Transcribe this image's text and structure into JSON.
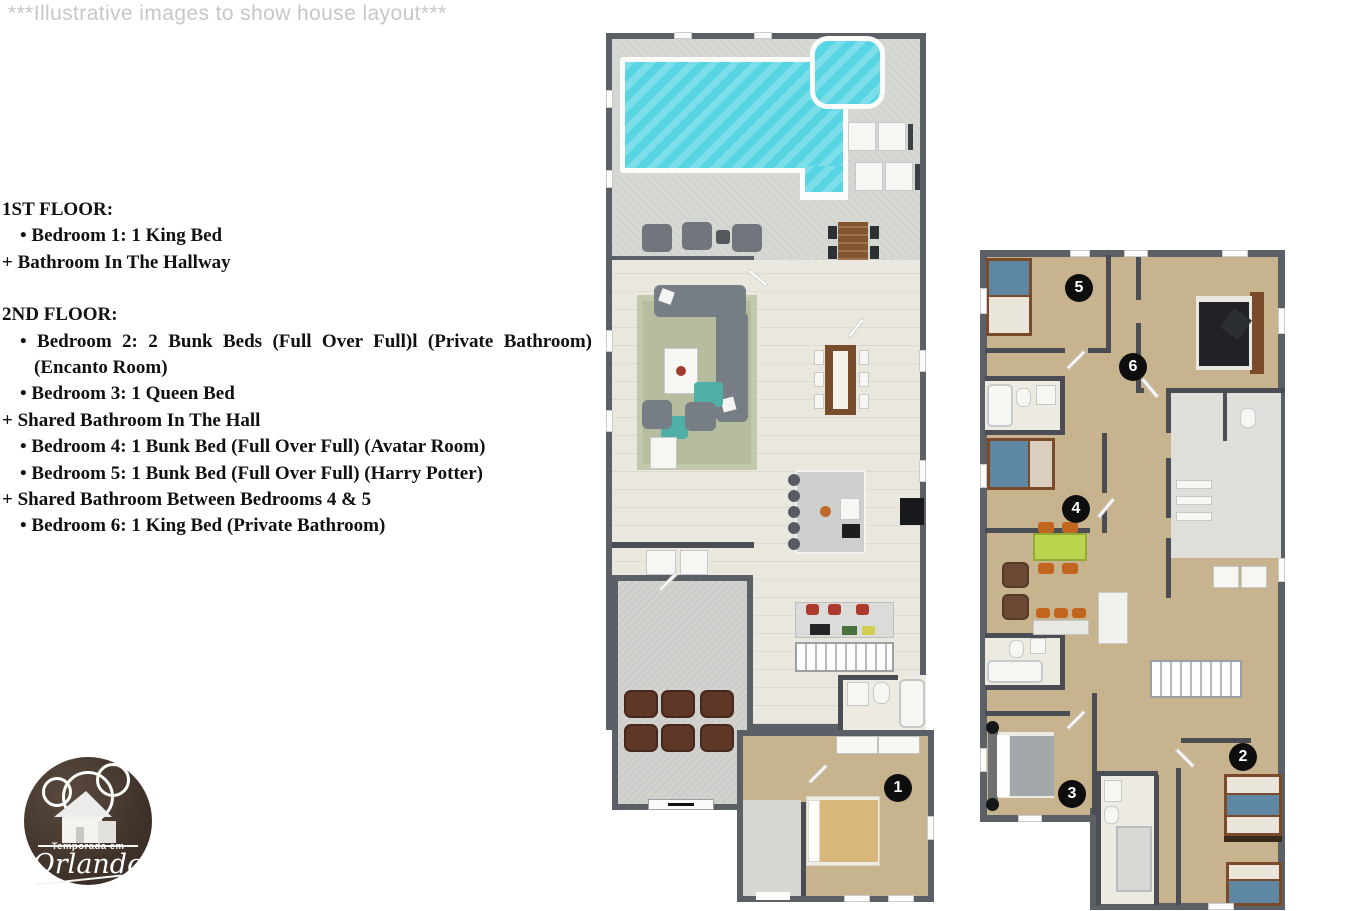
{
  "watermark": "***Illustrative images to show house layout***",
  "info": {
    "f1_heading": "1ST FLOOR:",
    "f1_line1": "• Bedroom 1: 1 King Bed",
    "f1_line2": "+ Bathroom In The Hallway",
    "f2_heading": "2ND FLOOR:",
    "f2_line1": "• Bedroom 2: 2 Bunk Beds (Full Over Full)l (Private Bathroom)",
    "f2_line1b": "(Encanto Room)",
    "f2_line2": "• Bedroom 3: 1 Queen Bed",
    "f2_line3": "+ Shared Bathroom In The Hall",
    "f2_line4": "• Bedroom 4: 1 Bunk Bed (Full Over Full) (Avatar Room)",
    "f2_line5": "• Bedroom 5: 1 Bunk Bed (Full Over Full) (Harry Potter)",
    "f2_line6": "+ Shared Bathroom Between Bedrooms 4 & 5",
    "f2_line7": "• Bedroom 6: 1 King Bed (Private Bathroom)"
  },
  "markers": {
    "bedroom1": "1",
    "bedroom2": "2",
    "bedroom3": "3",
    "bedroom4": "4",
    "bedroom5": "5",
    "bedroom6": "6"
  },
  "logo": {
    "tagline": "Temporada em",
    "name": "Orlando"
  },
  "colors": {
    "wall": "#5b5f66",
    "wallInner": "#4a4e54",
    "pool": "#57d5e2",
    "deck": "#d6d8d4",
    "tile": "#eae7de",
    "tan": "#c8b38f",
    "bath": "#edeae1",
    "garage": "#d2d3cf",
    "rug": "#b6bc9e",
    "sofa": "#767d84",
    "teal": "#4fafa7",
    "woodTable": "#84552f",
    "recliner": "#5e3726",
    "bunkBlue": "#5d87a2",
    "bunkWood": "#7a4a2a",
    "greenTable": "#b9d54d",
    "orangeChair": "#c2661f",
    "marker": "#0e0e0e",
    "watermark": "#c7c7c7",
    "logoBg": "#3c2f27"
  }
}
